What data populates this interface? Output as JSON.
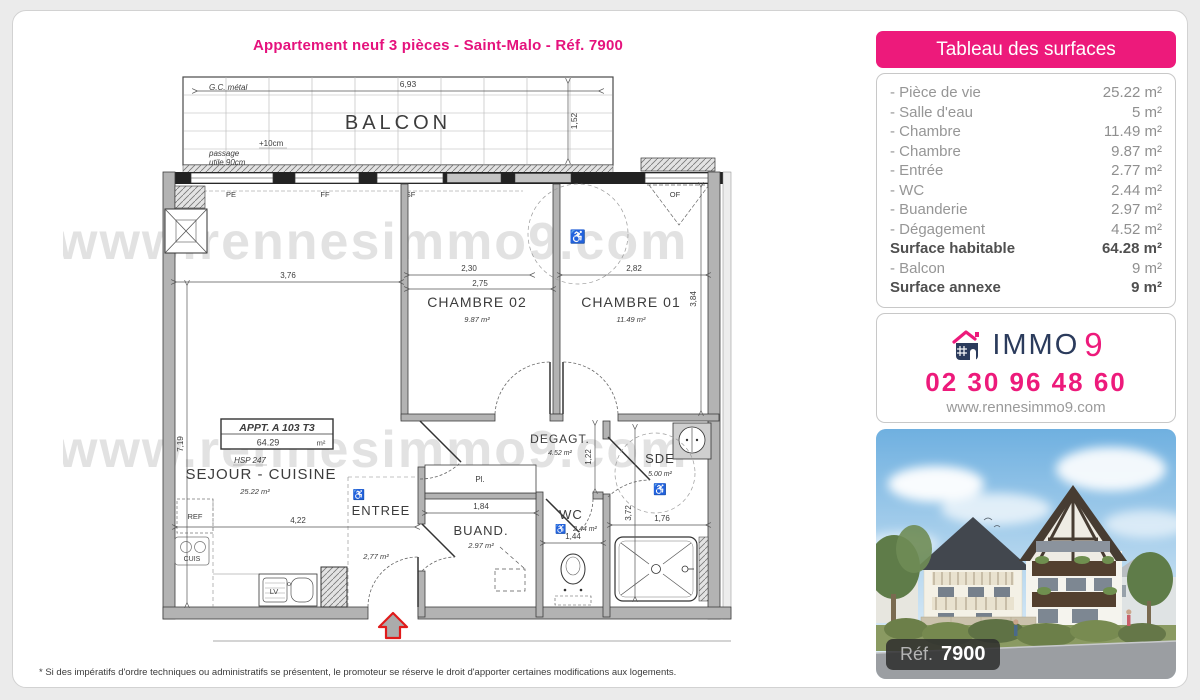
{
  "page": {
    "title": "Appartement neuf 3 pièces - Saint-Malo - Réf. 7900",
    "disclaimer": "* Si des impératifs d'ordre techniques ou administratifs se présentent, le promoteur se réserve le droit d'apporter certaines modifications aux logements.",
    "watermark": "www.rennesimmo9.com"
  },
  "colors": {
    "pink": "#ed1a7b",
    "navy": "#2b3b5c",
    "wall_gray": "#b3b3b3"
  },
  "surface_table": {
    "header": "Tableau des surfaces",
    "rows": [
      {
        "label": "- Pièce de vie",
        "value": "25.22 m²"
      },
      {
        "label": "- Salle d'eau",
        "value": "5 m²"
      },
      {
        "label": "- Chambre",
        "value": "11.49 m²"
      },
      {
        "label": "- Chambre",
        "value": "9.87 m²"
      },
      {
        "label": "- Entrée",
        "value": "2.77 m²"
      },
      {
        "label": "- WC",
        "value": "2.44 m²"
      },
      {
        "label": "- Buanderie",
        "value": "2.97 m²"
      },
      {
        "label": "- Dégagement",
        "value": "4.52 m²"
      },
      {
        "label": "Surface habitable",
        "value": "64.28 m²"
      },
      {
        "label": "- Balcon",
        "value": "9 m²"
      },
      {
        "label": "Surface annexe",
        "value": "9 m²"
      }
    ]
  },
  "agency": {
    "logo_text": "IMMO",
    "logo_digit": "9",
    "phone": "02 30 96 48 60",
    "website": "www.rennesimmo9.com"
  },
  "photo": {
    "ref_label": "Réf.",
    "ref_number": "7900"
  },
  "plan": {
    "appt_box": {
      "line1": "APPT. A 103 T3",
      "area": "64.29",
      "unit": "m²"
    },
    "rooms": {
      "balcon": "BALCON",
      "sejour": "SEJOUR - CUISINE",
      "sejour_area": "25.22  m²",
      "hsp": "HSP 247",
      "ch02": "CHAMBRE 02",
      "ch02_area": "9.87  m²",
      "ch01": "CHAMBRE 01",
      "ch01_area": "11.49  m²",
      "degagt": "DEGAGT.",
      "degagt_area": "4.52  m²",
      "entree": "ENTREE",
      "entree_area": "2,77  m²",
      "buand": "BUAND.",
      "buand_area": "2.97  m²",
      "wc": "WC",
      "wc_area": "2.44  m²",
      "sde": "SDE",
      "sde_area": "5.00  m²"
    },
    "dims": {
      "balcon_w": "6,93",
      "balcon_d": "1,52",
      "sejour_w": "3,76",
      "sejour_h": "7,19",
      "kitchen_w": "4,22",
      "ch02_w1": "2,30",
      "ch02_w2": "2,75",
      "ch01_w": "2,82",
      "ch01_h": "3,84",
      "degagt_h": "1,22",
      "buand_w": "1,84",
      "wc_w": "1,44",
      "sde_w": "1,76",
      "sde_h": "3,72"
    },
    "annotations": {
      "gc_metal": "G.C. métal",
      "plus10": "+10cm",
      "passage1": "passage",
      "passage2": "utile 90cm",
      "pe": "PE",
      "ff": "FF",
      "vsf": "VSF",
      "of": "OF",
      "pl": "Pl.",
      "ref": "REF",
      "cuis": "CUIS",
      "lv": "LV"
    },
    "icons": {
      "wheelchair": "♿"
    }
  }
}
